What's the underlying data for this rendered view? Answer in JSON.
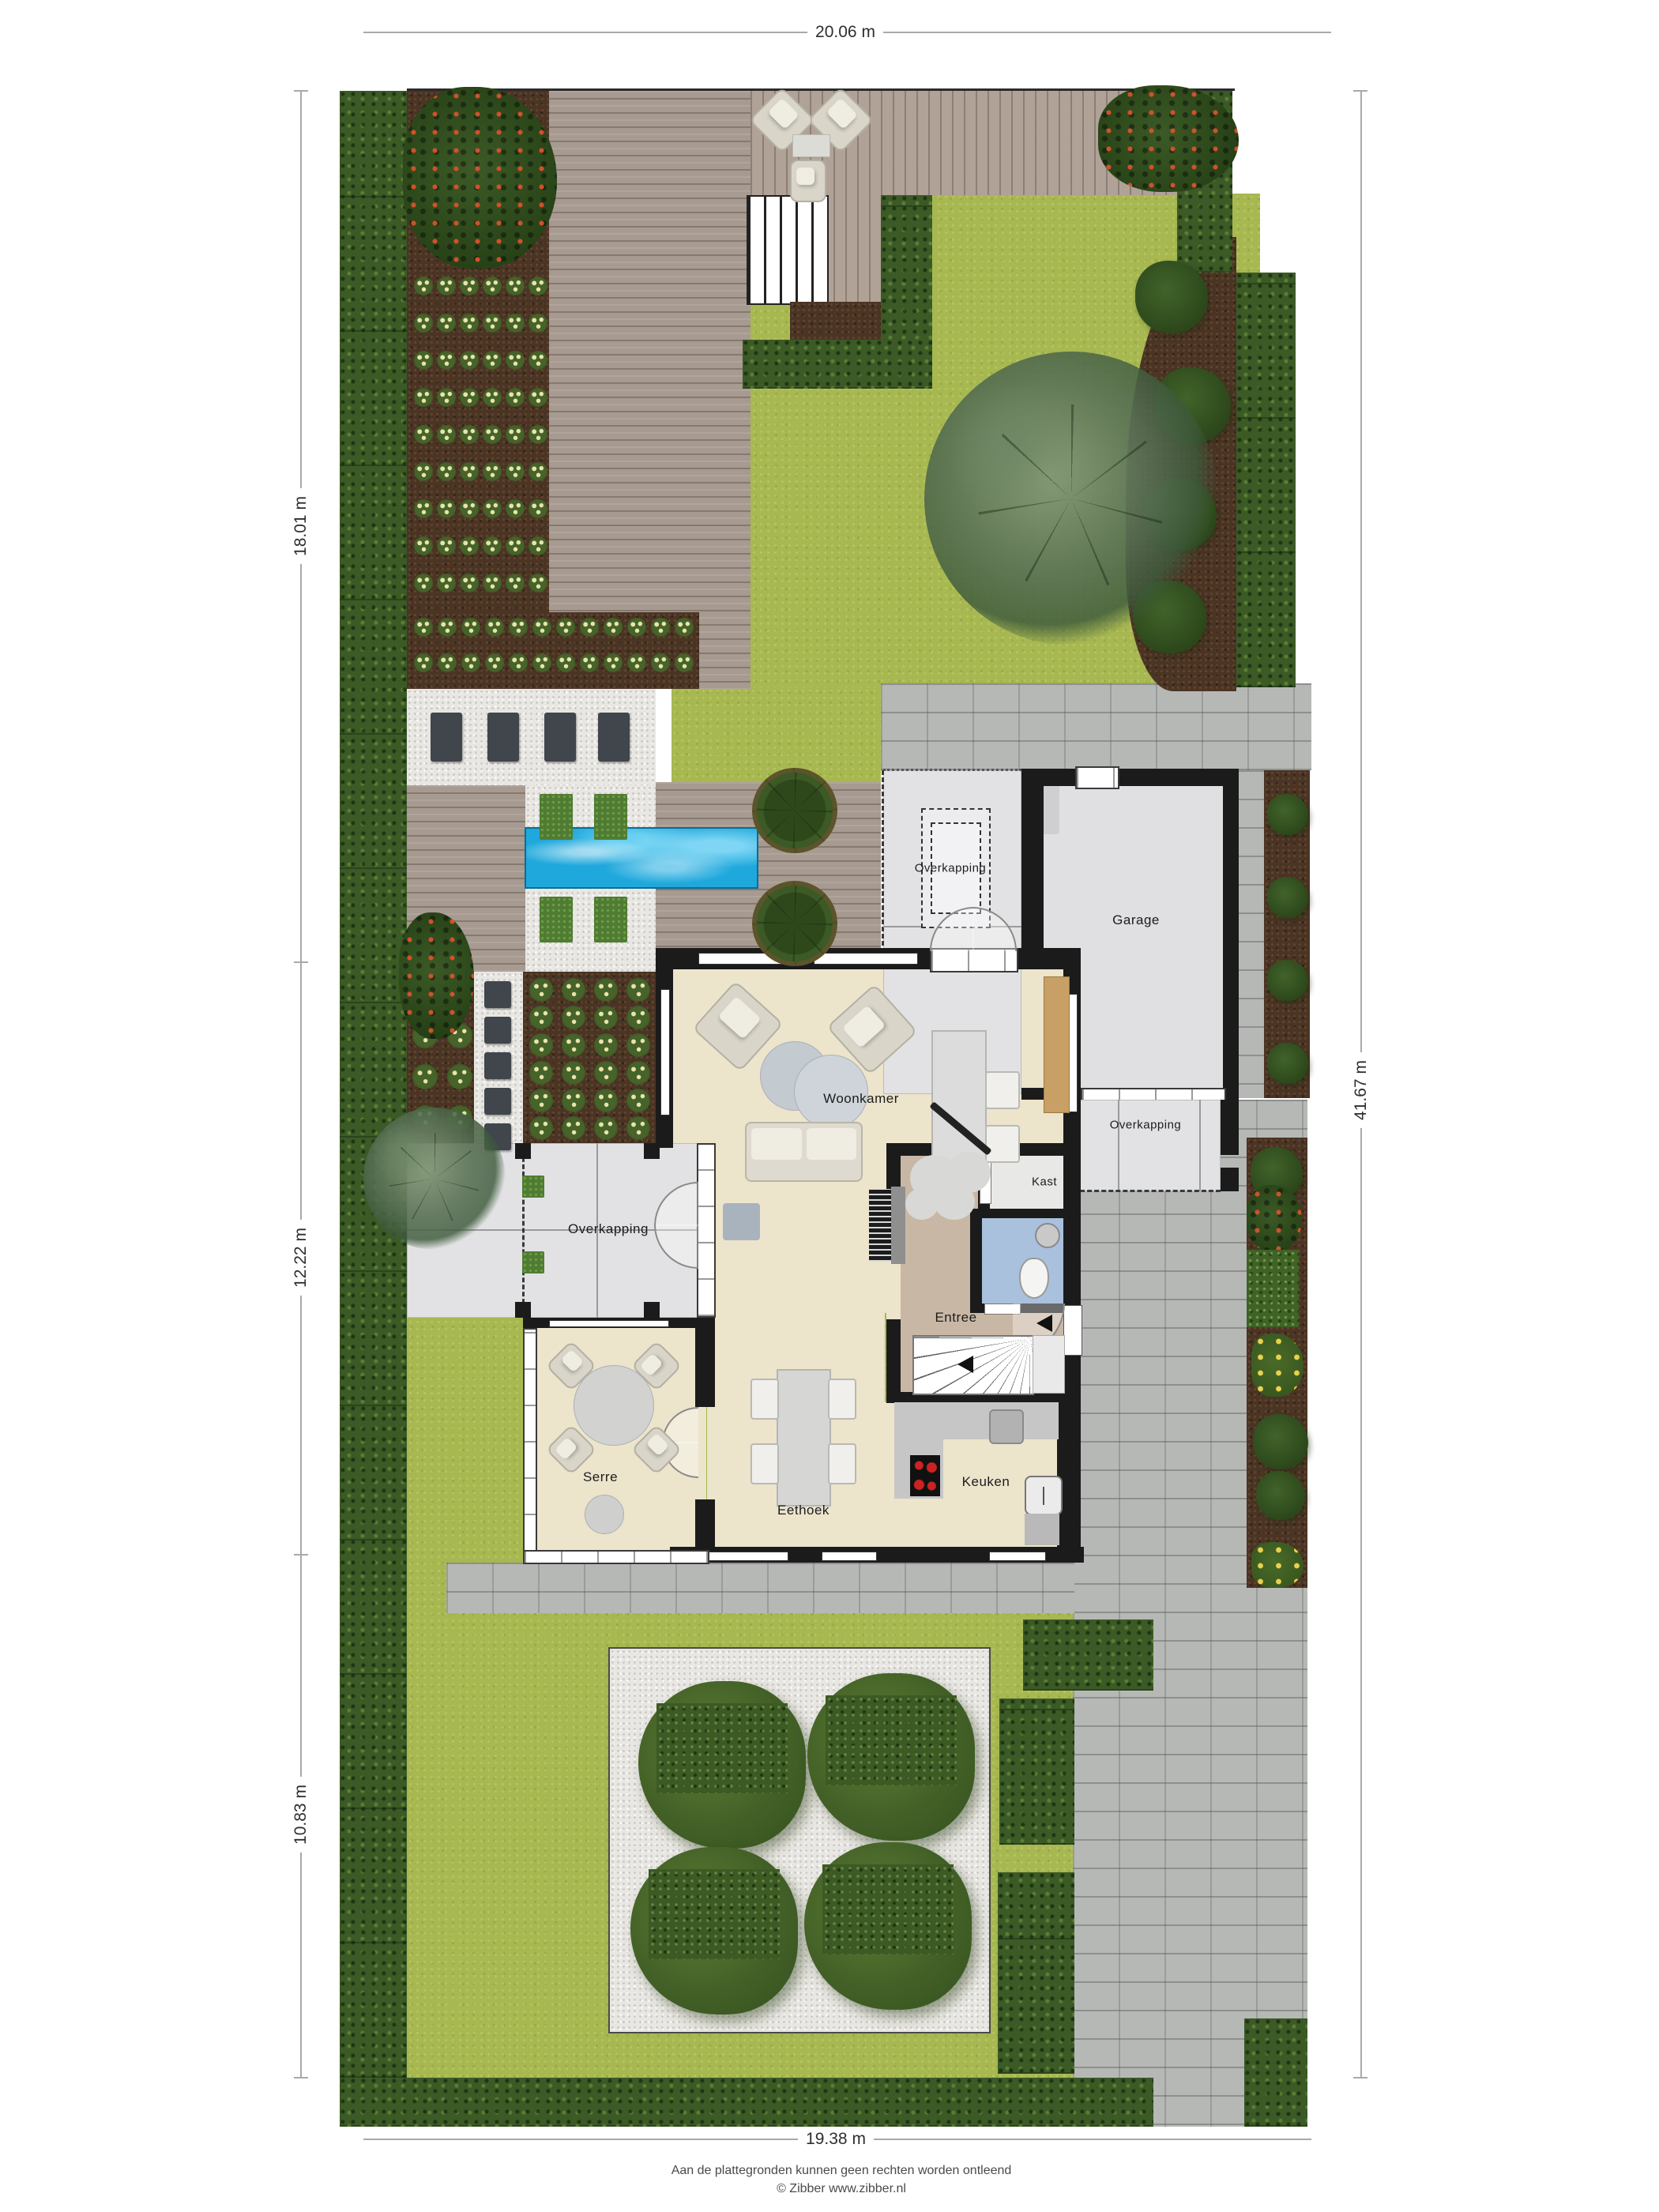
{
  "dimensions": {
    "top": "20.06 m",
    "bottom": "19.38 m",
    "left_top": "18.01 m",
    "left_middle": "12.22 m",
    "left_bottom": "10.83 m",
    "right": "41.67 m"
  },
  "rooms": {
    "woonkamer": "Woonkamer",
    "serre": "Serre",
    "eethoek": "Eethoek",
    "keuken": "Keuken",
    "entree": "Entree",
    "kast": "Kast",
    "garage": "Garage",
    "overkapping": "Overkapping"
  },
  "footer": {
    "line1": "Aan de plattegronden kunnen geen rechten worden ontleend",
    "line2": "© Zibber www.zibber.nl"
  },
  "colors": {
    "wall": "#1b1b1b",
    "floor_living": "#ece4cb",
    "floor_entree": "#c9b7a5",
    "floor_toilet": "#a9c1dd",
    "floor_garage": "#e0e0e2",
    "lawn": "#a7b851",
    "hedge": "#3b5a26",
    "soil": "#4a3424",
    "deck": "#a79a91",
    "gravel": "#e9e7e3",
    "pavers": "#b6b8b6",
    "pool": "#1fa8dc"
  }
}
